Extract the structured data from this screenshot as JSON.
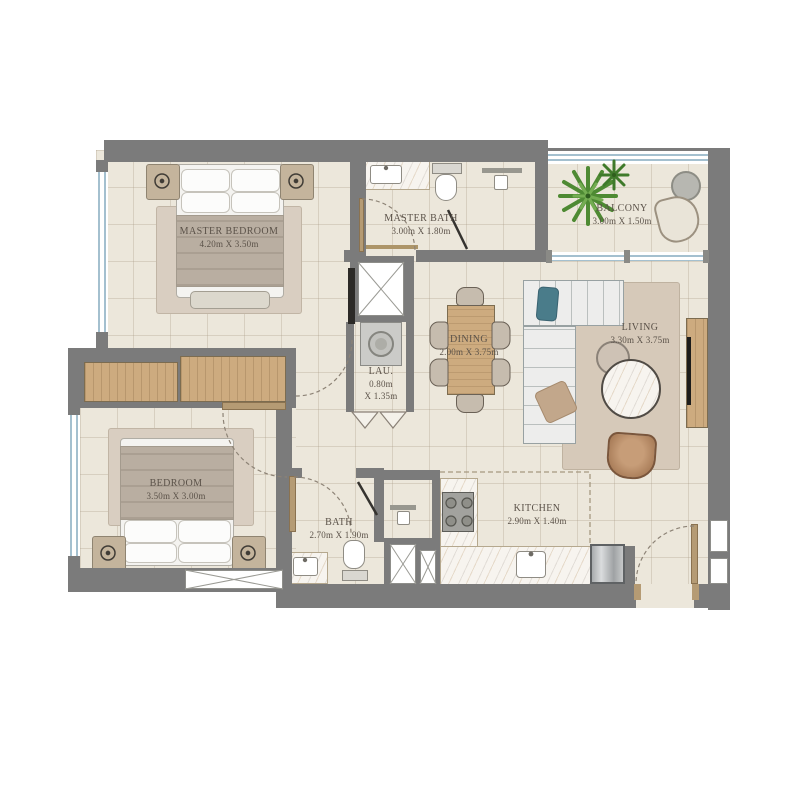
{
  "plan": {
    "type": "apartment-floor-plan",
    "rooms": {
      "master_bedroom": {
        "name": "MASTER BEDROOM",
        "dims": "4.20m X 3.50m"
      },
      "master_bath": {
        "name": "MASTER BATH",
        "dims": "3.00m X 1.80m"
      },
      "balcony": {
        "name": "BALCONY",
        "dims": "3.00m X 1.50m"
      },
      "dining": {
        "name": "DINING",
        "dims": "2.00m X 3.75m"
      },
      "living": {
        "name": "LIVING",
        "dims": "3.30m X 3.75m"
      },
      "laundry": {
        "name": "LAU.",
        "dims_line1": "0.80m",
        "dims_line2": "X 1.35m"
      },
      "bedroom": {
        "name": "BEDROOM",
        "dims": "3.50m X 3.00m"
      },
      "bath": {
        "name": "BATH",
        "dims": "2.70m X 1.90m"
      },
      "kitchen": {
        "name": "KITCHEN",
        "dims": "2.90m X 1.40m"
      }
    },
    "palette": {
      "wall": "#7b7b7b",
      "floor": "#ece7db",
      "label_text": "#5b5249",
      "wood": "#cdab7f",
      "rug": "#d9cec1",
      "window": "#a4c0cf",
      "sofa": "#ededec",
      "pillow_teal": "#4a7c8a",
      "pillow_tan": "#c2a78b",
      "armchair": "#a87c58",
      "plant_green": "#4e8a33",
      "marble": "#f7f4ef",
      "background": "#ffffff"
    }
  }
}
